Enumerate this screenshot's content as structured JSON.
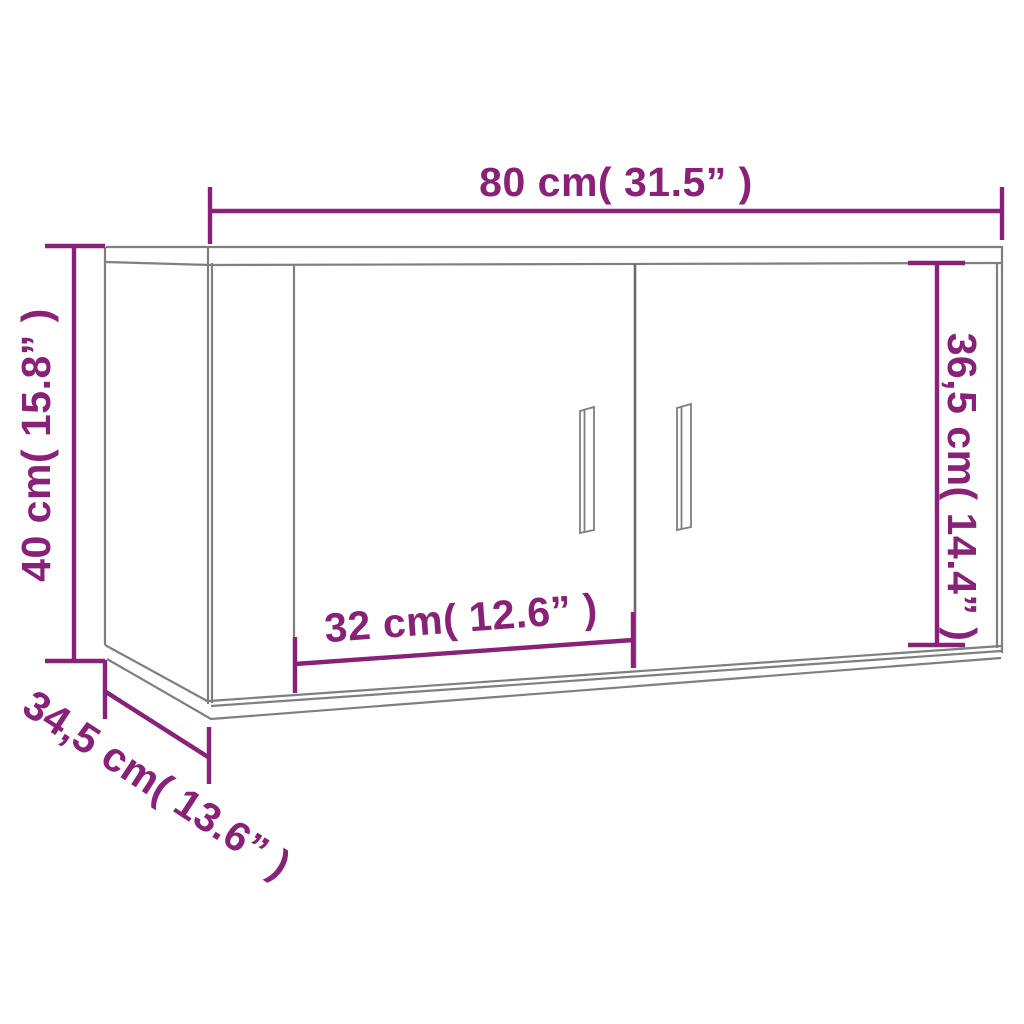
{
  "diagram": {
    "kind": "furniture-dimension-drawing",
    "subject": "wall-mounted two-door cabinet"
  },
  "labels": {
    "width": "80 cm( 31.5” )",
    "height": "40 cm( 15.8” )",
    "door_height": "36,5 cm( 14.4” )",
    "door_width": "32 cm( 12.6” )",
    "depth": "34,5 cm( 13.6” )"
  },
  "colors": {
    "dimension": "#8A2178",
    "outline": "#7F7F7F",
    "outline_dark": "#6A6A6A",
    "background": "#FFFFFF"
  }
}
